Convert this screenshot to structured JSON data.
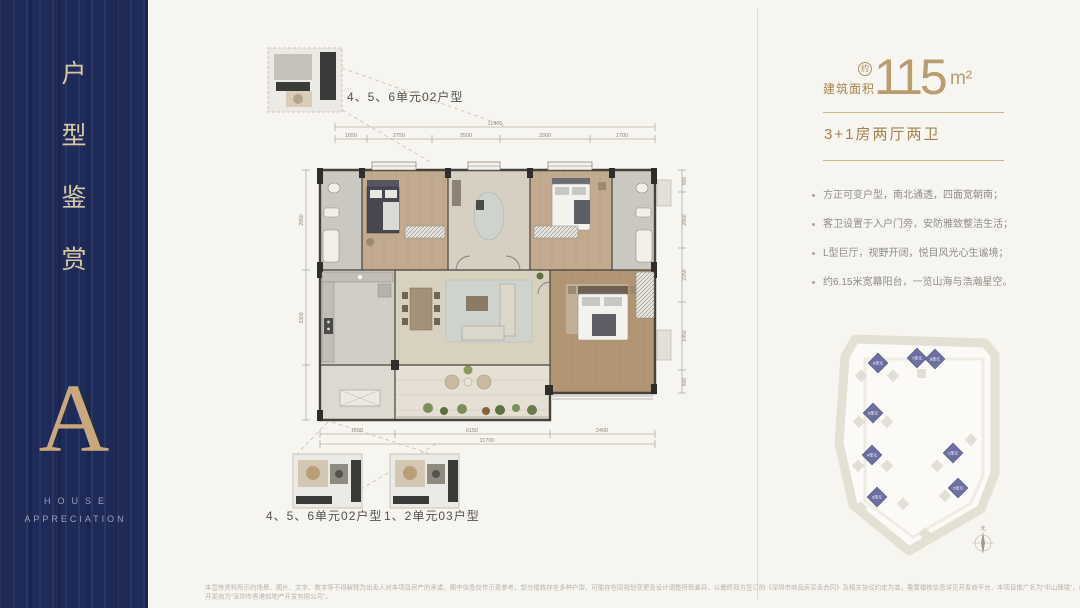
{
  "sidebar": {
    "title_chars": [
      "户",
      "型",
      "鉴",
      "赏"
    ],
    "letter": "A",
    "subtitle": [
      "HOUSE",
      "APPRECIATION"
    ]
  },
  "area": {
    "label": "建筑面积",
    "approx": "约",
    "value": "115",
    "unit": "m²"
  },
  "layout_type": "3+1房两厅两卫",
  "features": [
    "方正可变户型，南北通透，四面宽朝南；",
    "客卫设置于入户门旁，安防雅致整洁生活；",
    "L型巨厅，视野开阔，悦目风光心生谧境；",
    "约6.15米宽幕阳台，一览山海与浩瀚星空。"
  ],
  "plan": {
    "captions": {
      "top": "4、5、6单元02户型",
      "bottom_left": "4、5、6单元02户型",
      "bottom_right": "1、2单元03户型"
    },
    "dims": {
      "top_total": "11900",
      "top_segments": [
        "1650",
        "2750",
        "2500",
        "3300",
        "1700"
      ],
      "left": [
        "2850",
        "3300"
      ],
      "right": [
        "900",
        "2850",
        "2250",
        "1450",
        "600"
      ],
      "bottom_segments": [
        "1650",
        "6150",
        "2400"
      ],
      "bottom_total": "11700"
    }
  },
  "sitemap": {
    "buildings": [
      "6单元",
      "7单元",
      "8单元",
      "5单元",
      "4单元",
      "3单元",
      "1单元",
      "2单元"
    ],
    "compass": "北"
  },
  "disclaimer": {
    "line1": "本宣传资料所示的场景、图片、文字、数字等不得解释为出卖人对本项目房产的承诺，图中信息仅作示意参考，部分楼栋存在多种户型，可能存在因规划变更及设计调整所致差异，以最终双方签订的《深圳市商品房买卖合同》及相关协议约定为准，重要楼栋信息详见开发商平台，本项目推广名为“半山臻境”，备案名“半山臻境花园”",
    "line2": "开发商为“深圳市香港信地产开发有限公司”。"
  },
  "colors": {
    "accent_gold": "#a5854f",
    "sidebar_navy": "#1e2a58",
    "building_blue": "#6b70a1"
  }
}
